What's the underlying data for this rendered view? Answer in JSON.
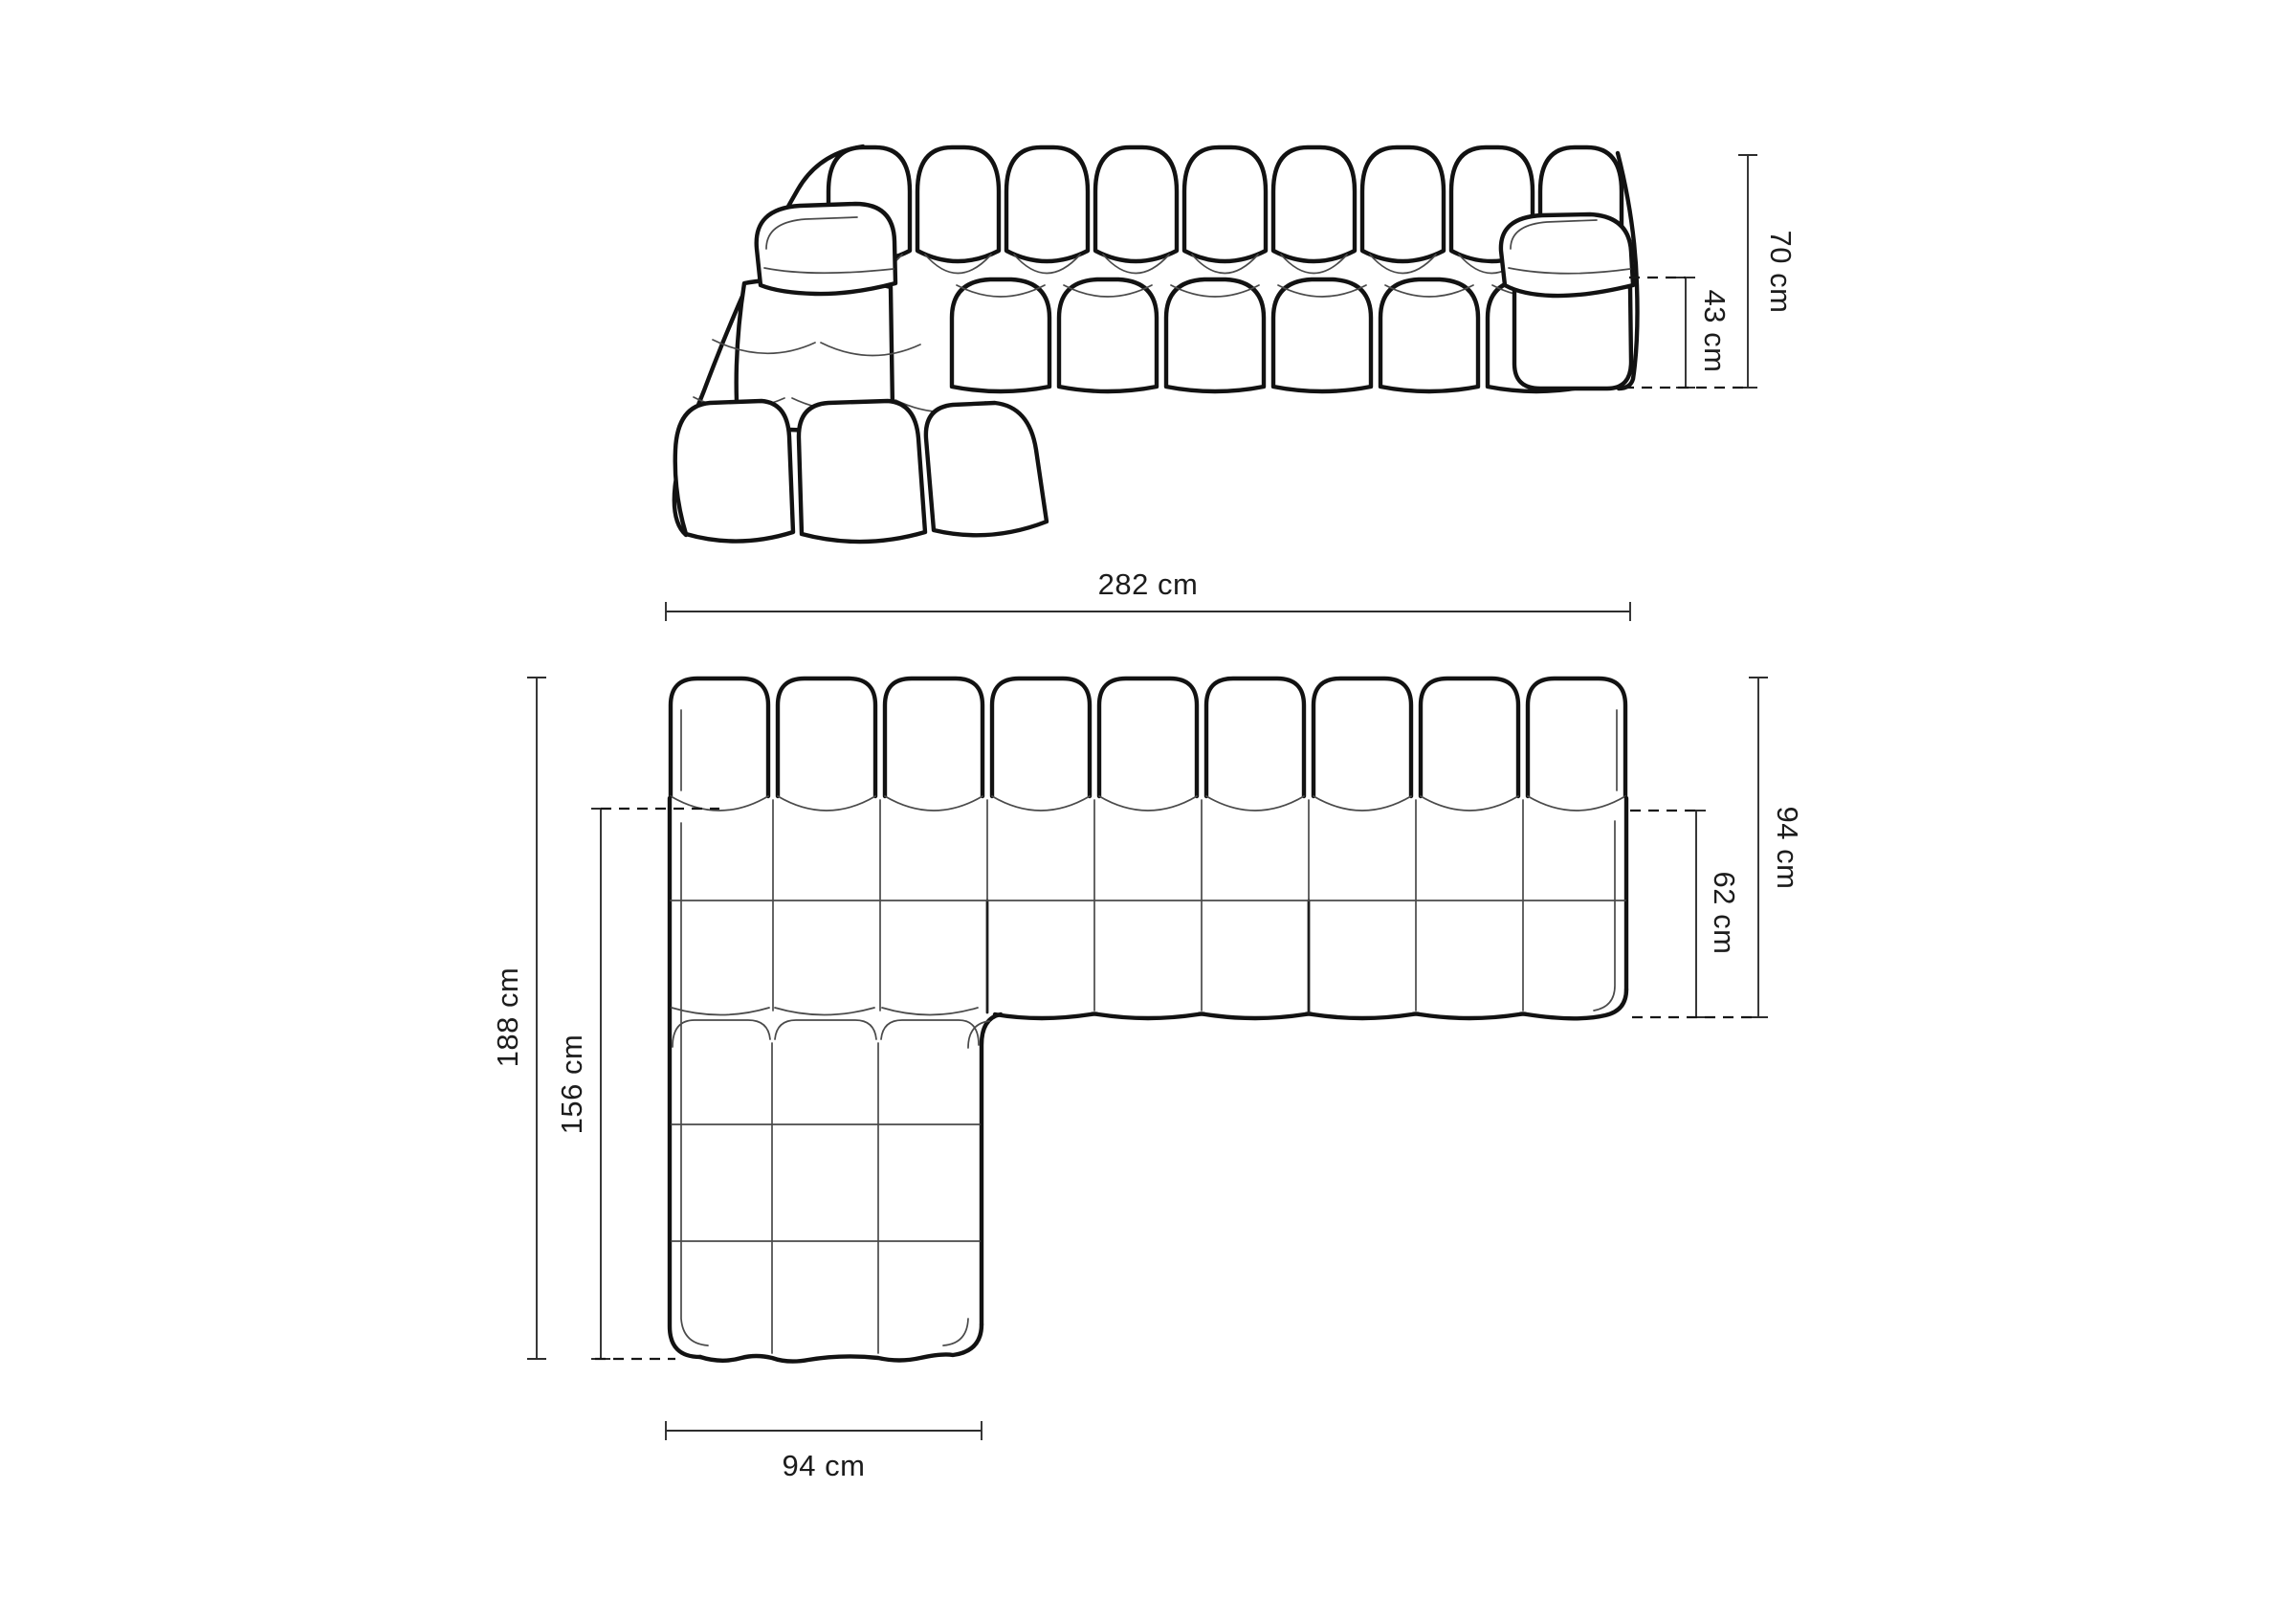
{
  "diagram": {
    "subject": "modular-sofa-dimension-diagram",
    "views": {
      "front_view": "front-perspective-line-drawing",
      "plan_view": "top-down-plan-line-drawing"
    }
  },
  "dimensions": {
    "height_total": {
      "label": "70 cm"
    },
    "height_seat": {
      "label": "43 cm"
    },
    "width_total": {
      "label": "282 cm"
    },
    "depth_total": {
      "label": "94 cm"
    },
    "seat_depth": {
      "label": "62 cm"
    },
    "length_total": {
      "label": "188 cm"
    },
    "chaise_length": {
      "label": "156 cm"
    },
    "chaise_width": {
      "label": "94 cm"
    }
  },
  "colors": {
    "background": "#ffffff",
    "outline": "#121212",
    "seam": "#4a4a4a",
    "dimension_line": "#2e2e2e",
    "text": "#1c1c1c"
  }
}
